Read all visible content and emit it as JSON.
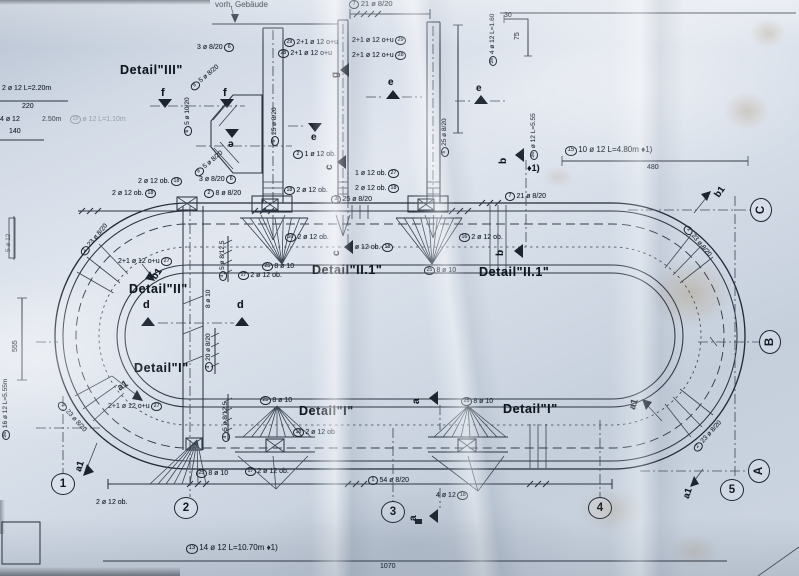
{
  "colors": {
    "paper": "#d2dae6",
    "ink": "#2b3441",
    "ink_strong": "#10161d",
    "stain": "#946c34"
  },
  "annotations": [
    {
      "n": "note-vorh-gebaeude",
      "t": "vorh. Gebäude",
      "x": 215,
      "y": 1,
      "s": 8
    },
    {
      "n": "bar-mark-7-top",
      "c1": "7",
      "t": "21 ø 8/20",
      "x": 349,
      "y": 0,
      "s": 7.5
    },
    {
      "n": "dim-30",
      "t": "30",
      "x": 504,
      "y": 12,
      "s": 7
    },
    {
      "n": "dim-75",
      "t": "75",
      "x": 514,
      "y": 40,
      "r": -90,
      "s": 7
    },
    {
      "n": "bar-mark-28-vert",
      "c1": "28",
      "t": "4 ø 12 L=1.60",
      "x": 489,
      "y": 66,
      "r": -90,
      "s": 6.5
    },
    {
      "n": "om-29-left",
      "c1": "29",
      "t": "2+1 ø 12 o+u",
      "x": 284,
      "y": 38,
      "s": 7
    },
    {
      "n": "om-28-left",
      "c1": "28",
      "t": "2+1 ø 12 o+u",
      "x": 278,
      "y": 49,
      "s": 7
    },
    {
      "n": "om-29-right",
      "t": "2+1 ø 12 o+u",
      "c2": "29",
      "x": 352,
      "y": 36,
      "s": 7
    },
    {
      "n": "om-28-right",
      "t": "2+1 ø 12 o+u",
      "c2": "28",
      "x": 352,
      "y": 51,
      "s": 7
    },
    {
      "n": "detail-label-iii",
      "t": "Detail\"III\"",
      "x": 120,
      "y": 64,
      "s": 12.5,
      "b": 1
    },
    {
      "n": "bar-mark-6-3oe820-top",
      "t": "3 ø 8/20",
      "c2": "6",
      "x": 197,
      "y": 43,
      "s": 7
    },
    {
      "n": "bar-mark-9-diag-top",
      "c1": "9",
      "t": "5 ø 8/20",
      "x": 189,
      "y": 86,
      "r": -40,
      "s": 6.5
    },
    {
      "n": "bar-mark-6-5oe1020",
      "c1": "6",
      "t": "5 ø 10/20",
      "x": 184,
      "y": 136,
      "r": -90,
      "s": 6.5
    },
    {
      "n": "bar-mark-9-diag-bot",
      "c1": "9",
      "t": "5 ø 8/20",
      "x": 193,
      "y": 172,
      "r": -40,
      "s": 6.5
    },
    {
      "n": "section-marker-f-left",
      "t": "f",
      "x": 161,
      "y": 88,
      "s": 11,
      "b": 1
    },
    {
      "n": "section-marker-f-right",
      "t": "f",
      "x": 223,
      "y": 88,
      "s": 11,
      "b": 1
    },
    {
      "n": "section-marker-e-1",
      "t": "e",
      "x": 388,
      "y": 78,
      "s": 10,
      "b": 1
    },
    {
      "n": "section-marker-e-2",
      "t": "e",
      "x": 476,
      "y": 84,
      "s": 10,
      "b": 1
    },
    {
      "n": "section-marker-e-3",
      "t": "e",
      "x": 311,
      "y": 133,
      "s": 10,
      "b": 1
    },
    {
      "n": "section-marker-e-4",
      "t": "e",
      "x": 228,
      "y": 138,
      "s": 10,
      "b": 1,
      "r": 180
    },
    {
      "n": "section-marker-g",
      "t": "g",
      "x": 331,
      "y": 78,
      "s": 10,
      "b": 1,
      "r": -90
    },
    {
      "n": "bar-mark-5-left",
      "c1": "5",
      "t": "25 ø 8/20",
      "x": 271,
      "y": 146,
      "r": -90,
      "s": 6.5
    },
    {
      "n": "bar-mark-5-right",
      "c1": "5",
      "t": "25 ø 8/20",
      "x": 441,
      "y": 157,
      "r": -90,
      "s": 6.5
    },
    {
      "n": "bar-mark-26-mid",
      "c1": "26",
      "t": "ø 12 L=5.55",
      "x": 530,
      "y": 160,
      "r": -90,
      "s": 6.5
    },
    {
      "n": "note-diamond-b",
      "t": "♦1)",
      "x": 527,
      "y": 164,
      "s": 9,
      "b": 1
    },
    {
      "n": "section-marker-b-top",
      "t": "b",
      "x": 499,
      "y": 164,
      "s": 10,
      "b": 1,
      "r": -90
    },
    {
      "n": "section-marker-b-bot",
      "t": "b",
      "x": 496,
      "y": 256,
      "s": 10,
      "b": 1,
      "r": -90
    },
    {
      "n": "bar-mark-15-line",
      "c1": "15",
      "t": "10 ø 12 L=4.80m ♦1)",
      "x": 565,
      "y": 146,
      "s": 8
    },
    {
      "n": "dim-480",
      "t": "480",
      "x": 647,
      "y": 164,
      "s": 7
    },
    {
      "n": "bar-mark-7-mid",
      "c1": "7",
      "t": "21 ø 8/20",
      "x": 505,
      "y": 192,
      "s": 7
    },
    {
      "n": "bar-mark-2-1oe12ob",
      "c1": "2",
      "t": "1 ø 12 ob.",
      "x": 293,
      "y": 150,
      "s": 7
    },
    {
      "n": "bar-mark-27-1oe12ob",
      "t": "1 ø 12 ob.",
      "c2": "27",
      "x": 355,
      "y": 169,
      "s": 7
    },
    {
      "n": "bar-mark-18-a",
      "c1": "18",
      "t": "2 ø 12 ob.",
      "x": 284,
      "y": 186,
      "s": 7
    },
    {
      "n": "bar-mark-18-b",
      "t": "2 ø 12 ob.",
      "c2": "18",
      "x": 355,
      "y": 184,
      "s": 7
    },
    {
      "n": "bar-mark-3-25oe820",
      "c1": "3",
      "t": "25 ø 8/20",
      "x": 331,
      "y": 195,
      "s": 7
    },
    {
      "n": "bar-mark-2-8oe820",
      "c1": "2",
      "t": "8 ø 8/20",
      "x": 204,
      "y": 189,
      "s": 7
    },
    {
      "n": "bar-mark-6-3oe820-mid",
      "t": "3 ø 8/20",
      "c2": "6",
      "x": 199,
      "y": 175,
      "s": 7
    },
    {
      "n": "bar-mark-18-left-a",
      "t": "2 ø 12 ob.",
      "c2": "18",
      "x": 138,
      "y": 177,
      "s": 7
    },
    {
      "n": "bar-mark-18-left-b",
      "t": "2 ø 12 ob.",
      "c2": "18",
      "x": 112,
      "y": 189,
      "s": 7
    },
    {
      "n": "bar-mark-16-mid",
      "c1": "16",
      "t": "2 ø 12 ob.",
      "x": 285,
      "y": 233,
      "s": 7
    },
    {
      "n": "bar-mark-18-mid2",
      "t": "2 ø 12 ob.",
      "c2": "18",
      "x": 349,
      "y": 243,
      "s": 7
    },
    {
      "n": "bar-mark-25-top-left",
      "c1": "25",
      "t": "8 ø 10",
      "x": 262,
      "y": 262,
      "s": 7
    },
    {
      "n": "bar-mark-17-top",
      "c1": "17",
      "t": "2 ø 12 ob.",
      "x": 238,
      "y": 271,
      "s": 7
    },
    {
      "n": "detail-label-ii1-left",
      "t": "Detail\"II.1\"",
      "x": 312,
      "y": 264,
      "s": 12.5,
      "b": 1
    },
    {
      "n": "detail-label-ii",
      "t": "Detail\"II\"",
      "x": 129,
      "y": 283,
      "s": 12.5,
      "b": 1
    },
    {
      "n": "om-27-mid",
      "t": "2+1 ø 12 o+u",
      "c2": "27",
      "x": 118,
      "y": 257,
      "s": 7
    },
    {
      "n": "section-marker-b1-left",
      "t": "b1",
      "x": 150,
      "y": 276,
      "s": 9.5,
      "b": 1,
      "r": -55
    },
    {
      "n": "section-marker-d-left",
      "t": "d",
      "x": 143,
      "y": 300,
      "s": 11,
      "b": 1
    },
    {
      "n": "section-marker-d-right",
      "t": "d",
      "x": 237,
      "y": 300,
      "s": 11,
      "b": 1
    },
    {
      "n": "bar-mark-4-5oe8125-top",
      "c1": "4",
      "t": "5 ø 8/12.5",
      "x": 219,
      "y": 281,
      "r": -90,
      "s": 6.5
    },
    {
      "n": "bar-mark-8oe10-vert",
      "t": "8 ø 10",
      "x": 206,
      "y": 308,
      "r": -90,
      "s": 6.5
    },
    {
      "n": "bar-mark-16-right",
      "c1": "16",
      "t": "2 ø 12 ob.",
      "x": 459,
      "y": 233,
      "s": 7
    },
    {
      "n": "detail-label-ii1-right",
      "t": "Detail\"II.1\"",
      "x": 479,
      "y": 266,
      "s": 12.5,
      "b": 1
    },
    {
      "n": "bar-mark-25-top-right",
      "c1": "25",
      "t": "8 ø 10",
      "x": 424,
      "y": 266,
      "s": 7
    },
    {
      "n": "bar-mark-2-23-tl",
      "c1": "2",
      "t": "23 ø 8/20",
      "x": 79,
      "y": 252,
      "r": -50,
      "s": 6.5
    },
    {
      "n": "bar-mark-2-23-bl",
      "c1": "2",
      "t": "23 ø 8/20",
      "x": 62,
      "y": 400,
      "r": 48,
      "s": 6.5
    },
    {
      "n": "bar-mark-2-23-tr",
      "c1": "2",
      "t": "23 ø 8/20",
      "x": 688,
      "y": 224,
      "r": 50,
      "s": 6.5
    },
    {
      "n": "bar-mark-2-23-br",
      "c1": "2",
      "t": "23 ø 8/20",
      "x": 692,
      "y": 448,
      "r": -48,
      "s": 6.5
    },
    {
      "n": "label-2oe12ob-bl",
      "t": "2 ø 12 ob.",
      "x": 96,
      "y": 499,
      "s": 7
    },
    {
      "n": "detail-label-i-left",
      "t": "Detail\"I\"",
      "x": 134,
      "y": 362,
      "s": 12.5,
      "b": 1
    },
    {
      "n": "section-marker-a1-left",
      "t": "a1",
      "x": 116,
      "y": 385,
      "s": 9.5,
      "b": 1,
      "r": -33
    },
    {
      "n": "om-27-bot",
      "t": "2+1 ø 12 o+u",
      "c2": "27",
      "x": 108,
      "y": 402,
      "s": 7
    },
    {
      "n": "bar-mark-4-20oe820",
      "c1": "4",
      "t": "20 ø 8/20",
      "x": 205,
      "y": 372,
      "r": -90,
      "s": 6.5
    },
    {
      "n": "bar-mark-4-5oe8125-bot",
      "c1": "4",
      "t": "5 ø 8/12.5",
      "x": 222,
      "y": 442,
      "r": -90,
      "s": 6.5
    },
    {
      "n": "bar-mark-25-bl-top",
      "c1": "25",
      "t": "8 ø 10",
      "x": 260,
      "y": 396,
      "s": 7
    },
    {
      "n": "detail-label-i-mid",
      "t": "Detail\"I\"",
      "x": 299,
      "y": 405,
      "s": 12.5,
      "b": 1
    },
    {
      "n": "bar-mark-18-bl",
      "c1": "18",
      "t": "2 ø 12 ob",
      "x": 293,
      "y": 428,
      "s": 7
    },
    {
      "n": "bar-mark-25-bl-bot",
      "c1": "25",
      "t": "8 ø 10",
      "x": 196,
      "y": 469,
      "s": 7
    },
    {
      "n": "bar-mark-17-bot",
      "c1": "17",
      "t": "2 ø 12 ob.",
      "x": 245,
      "y": 467,
      "s": 7
    },
    {
      "n": "bar-mark-25-br",
      "c1": "25",
      "t": "8 ø 10",
      "x": 461,
      "y": 397,
      "s": 7
    },
    {
      "n": "detail-label-i-right",
      "t": "Detail\"I\"",
      "x": 503,
      "y": 403,
      "s": 12.5,
      "b": 1
    },
    {
      "n": "section-marker-a-mid",
      "t": "a",
      "x": 412,
      "y": 404,
      "s": 10,
      "b": 1,
      "r": -90
    },
    {
      "n": "bar-mark-1-54oe820",
      "c1": "1",
      "t": "54 ø 8/20",
      "x": 368,
      "y": 476,
      "s": 7
    },
    {
      "n": "bar-mark-18-4oe12",
      "t": "4 ø 12",
      "c2": "18",
      "x": 436,
      "y": 491,
      "s": 7
    },
    {
      "n": "section-marker-a-bot",
      "t": "a",
      "x": 409,
      "y": 521,
      "s": 10,
      "b": 1,
      "r": -90
    },
    {
      "n": "section-marker-a1-bl",
      "t": "a1",
      "x": 74,
      "y": 470,
      "s": 9.5,
      "b": 1,
      "r": -72
    },
    {
      "n": "section-marker-b1-tr",
      "t": "b1",
      "x": 713,
      "y": 194,
      "s": 9.5,
      "b": 1,
      "r": -55
    },
    {
      "n": "section-marker-a1-br1",
      "t": "a1",
      "x": 628,
      "y": 408,
      "s": 9.5,
      "b": 1,
      "r": -72
    },
    {
      "n": "section-marker-a1-br2",
      "t": "a1",
      "x": 682,
      "y": 497,
      "s": 9.5,
      "b": 1,
      "r": -72
    },
    {
      "n": "bar-mark-13-line",
      "c1": "13",
      "t": "14 ø 12 L=10.70m ♦1)",
      "x": 186,
      "y": 544,
      "s": 8
    },
    {
      "n": "dim-1070",
      "t": "1070",
      "x": 380,
      "y": 563,
      "s": 7
    },
    {
      "n": "cat-2oe12",
      "t": "2 ø 12 L=2.20m",
      "x": 2,
      "y": 85,
      "s": 7
    },
    {
      "n": "dim-220",
      "t": "220",
      "x": 22,
      "y": 103,
      "s": 7
    },
    {
      "n": "cat-4oe12",
      "t": "4 ø 12",
      "x": 0,
      "y": 116,
      "s": 7
    },
    {
      "n": "cat-250m",
      "t": "2.50m",
      "x": 42,
      "y": 116,
      "s": 7,
      "o": 0.7
    },
    {
      "n": "dim-140",
      "t": "140",
      "x": 9,
      "y": 128,
      "s": 7
    },
    {
      "n": "cat-18-faint",
      "c1": "18",
      "t": "ø 12 L=1.10m",
      "x": 70,
      "y": 115,
      "s": 7,
      "o": 0.3
    },
    {
      "n": "dim-555",
      "t": "555",
      "x": 12,
      "y": 352,
      "r": -90,
      "s": 7
    },
    {
      "n": "cat-26-left",
      "c1": "26",
      "t": "16 ø 12 L=5.55m",
      "x": 2,
      "y": 440,
      "r": -90,
      "s": 6.5
    },
    {
      "n": "cat-5oe12-partial",
      "t": "5 ø 12",
      "x": 6,
      "y": 252,
      "r": -90,
      "s": 6.5,
      "o": 0.55
    },
    {
      "n": "section-marker-c-top",
      "t": "c",
      "x": 325,
      "y": 170,
      "s": 10,
      "b": 1,
      "r": -90
    },
    {
      "n": "section-marker-c-bot",
      "t": "c",
      "x": 332,
      "y": 256,
      "s": 10,
      "b": 1,
      "r": -90
    }
  ],
  "axis_circles": [
    {
      "label": "1",
      "x": 63,
      "y": 484
    },
    {
      "label": "2",
      "x": 186,
      "y": 508
    },
    {
      "label": "3",
      "x": 393,
      "y": 512
    },
    {
      "label": "4",
      "x": 600,
      "y": 508
    },
    {
      "label": "5",
      "x": 732,
      "y": 490
    },
    {
      "label": "A",
      "x": 759,
      "y": 471,
      "rot": -90
    },
    {
      "label": "B",
      "x": 770,
      "y": 342,
      "rot": -90
    },
    {
      "label": "C",
      "x": 761,
      "y": 210,
      "rot": -90
    }
  ]
}
